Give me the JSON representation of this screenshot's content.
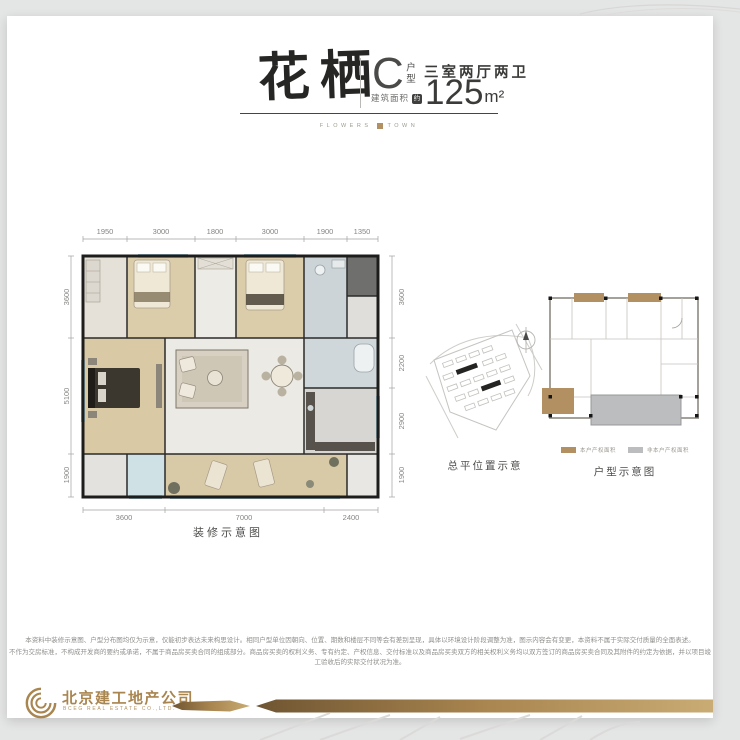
{
  "header": {
    "title": "花栖",
    "unit_letter": "C",
    "unit_type_label": "户型",
    "rooms_summary": "三室两厅两卫",
    "area_label": "建筑面积",
    "area_approx_badge": "约",
    "area_value": "125",
    "area_unit": "m²",
    "tagline_left": "FLOWERS",
    "tagline_right": "TOWN"
  },
  "floor_plan": {
    "caption": "装修示意图",
    "dims_top": [
      "1950",
      "3000",
      "1800",
      "3000",
      "1900",
      "1350"
    ],
    "dims_left": [
      "3600",
      "5100",
      "1900"
    ],
    "dims_right": [
      "3600",
      "2200",
      "2900",
      "1900"
    ],
    "dims_bottom": [
      "3600",
      "7000",
      "2400"
    ]
  },
  "site_plan": {
    "caption": "总平位置示意"
  },
  "unit_plan": {
    "caption": "户型示意图",
    "legend": [
      {
        "label": "本户产权面积",
        "color": "#b39062"
      },
      {
        "label": "非本户产权面积",
        "color": "#bcbdbf"
      }
    ]
  },
  "disclaimer": {
    "line1": "本资料中装修示意图、户型分布图均仅为示意，仅能初步表达未来构思设计。相同户型单位因朝向、位置、期数和楼层不同等会有差别呈现，具体以环境设计阶段调整为准，图示内容会有变更，本资料不属于实际交付质量的全面表述。",
    "line2": "不作为交房标准，不构成开发商的要约或承诺，不属于商品房买卖合同的组成部分。商品房买卖的权利义务、专有约定、产权信息、交付标准以及商品房买卖双方的相关权利义务均以双方签订的商品房买卖合同及其附件的约定为依据，并以项目竣工验收后的实际交付状况为准。"
  },
  "footer": {
    "company_cn": "北京建工地产公司",
    "company_en": "BCEG REAL ESTATE CO.,LTD.",
    "accent_color": "#a9854f"
  },
  "colors": {
    "background": "#e4e5e5",
    "card": "#ffffff",
    "gold": "#a9854f",
    "tan_area": "#b39062",
    "gray_area": "#bcbdbf",
    "window_teal": "#9cc4ce"
  }
}
